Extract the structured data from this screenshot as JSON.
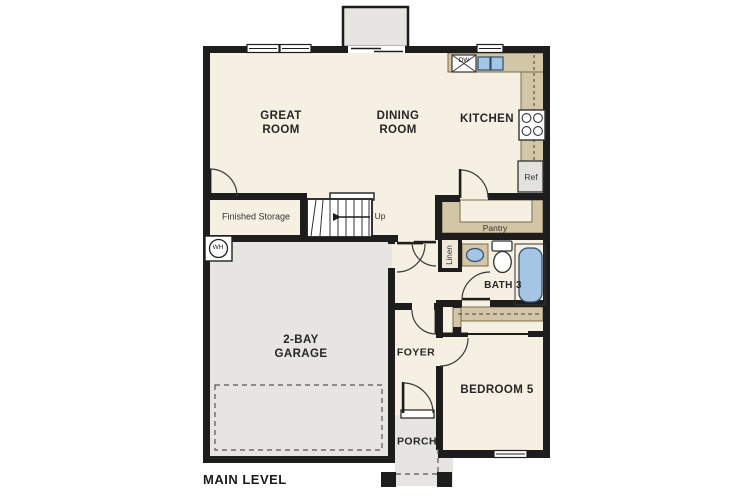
{
  "plan": {
    "title": "MAIN LEVEL",
    "rooms": {
      "great_room": "GREAT ROOM",
      "dining_room": "DINING ROOM",
      "kitchen": "KITCHEN",
      "garage": "2-BAY GARAGE",
      "foyer": "FOYER",
      "bedroom5": "BEDROOM 5",
      "bath3": "BATH 3",
      "porch": "PORCH",
      "pantry": "Pantry",
      "linen": "Linen",
      "finished_storage": "Finished Storage"
    },
    "annotations": {
      "up": "Up",
      "ref": "Ref",
      "dw": "DW",
      "wh": "WH"
    },
    "colors": {
      "floor": "#f6f0e2",
      "garage_floor": "#e6e5e1",
      "wall": "#1d1d1d",
      "counter_tan": "#d3c6a6",
      "fixture_blue": "#a4c6e4"
    }
  }
}
